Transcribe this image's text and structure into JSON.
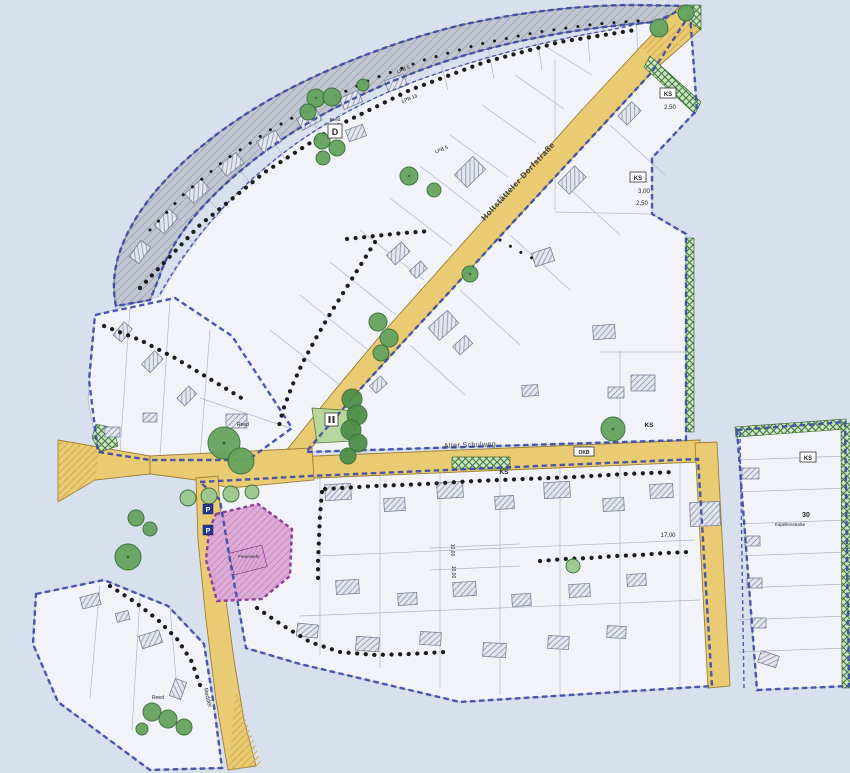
{
  "map": {
    "background": "#d8e0ed",
    "colors": {
      "bg": "#d8e0ed",
      "paper": "#f1f3f8",
      "paper_line": "#aeb6c6",
      "road": "#e9cb74",
      "road_edge": "#9c7f35",
      "road_hatch": "#d9ae52",
      "band": "#c2c6d1",
      "band_hatch": "#a3a8b6",
      "boundary": "#3c4ca6",
      "building": "#e3e6ee",
      "building_hatch": "#8d95a9",
      "tree": "#66a35f",
      "tree_dark": "#3a7038",
      "tree_cluster": "#4e8f49",
      "tree_light": "#9cc78e",
      "hedge": "#cfe3c5",
      "hedge_line": "#3f7d3a",
      "island": "#b9d79d",
      "pink": "#dcabd7",
      "pink_hatch": "#c489c0",
      "pink_border": "#8f3f93",
      "ink": "#232323",
      "dots": "#1c1c1c",
      "sign_blue": "#21388f"
    },
    "streets": {
      "dorfstrasse": "Holtstätteler Dorfstraße",
      "schulweg": "Alter Schulweg",
      "kapellenstrasse": "Kapellenstraße",
      "redder": "Redder"
    },
    "labels": {
      "d_shelter": "D",
      "parking": "P",
      "okb": "OKB",
      "ks": "KS",
      "reed": "Reed",
      "lpb_5": "LPB 5",
      "lpb_13": "LPB 13",
      "dim_3_00": "3,00",
      "dim_2_50": "2,50",
      "dim_17_00": "17,00",
      "dim_10_00": "10,00",
      "parcel_30": "30",
      "pink_area": "Feuerwehr"
    }
  }
}
